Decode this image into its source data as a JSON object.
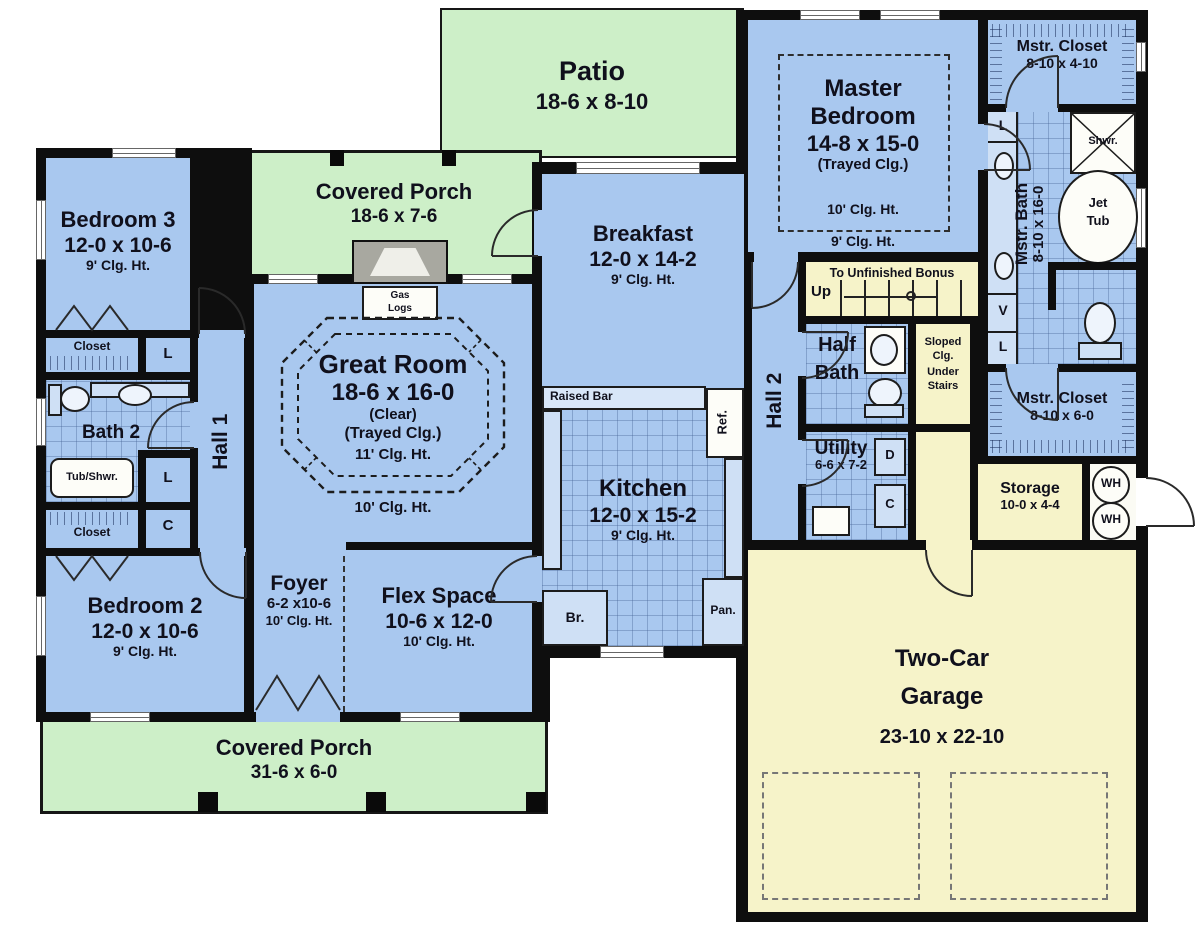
{
  "plan": {
    "patio": {
      "name": "Patio",
      "dims": "18-6 x 8-10"
    },
    "porch_top": {
      "name": "Covered Porch",
      "dims": "18-6 x 7-6"
    },
    "porch_bottom": {
      "name": "Covered Porch",
      "dims": "31-6 x 6-0"
    },
    "bedroom3": {
      "name": "Bedroom 3",
      "dims": "12-0 x 10-6",
      "clg": "9' Clg. Ht."
    },
    "bedroom2": {
      "name": "Bedroom 2",
      "dims": "12-0 x 10-6",
      "clg": "9' Clg. Ht."
    },
    "closet_top": {
      "name": "Closet"
    },
    "closet_bottom": {
      "name": "Closet"
    },
    "linen_upper": "L",
    "linen_lower": "L",
    "coat": "C",
    "bath2": {
      "name": "Bath 2",
      "tub": "Tub/Shwr."
    },
    "hall1": {
      "name": "Hall 1"
    },
    "hall2": {
      "name": "Hall 2"
    },
    "foyer": {
      "name": "Foyer",
      "dims": "6-2 x10-6",
      "clg": "10' Clg. Ht."
    },
    "flex": {
      "name": "Flex Space",
      "dims": "10-6 x 12-0",
      "clg": "10' Clg. Ht."
    },
    "great_room": {
      "name": "Great Room",
      "dims": "18-6 x 16-0",
      "clear": "(Clear)",
      "tray": "(Trayed Clg.)",
      "clg_inner": "11' Clg. Ht.",
      "clg_outer": "10' Clg. Ht."
    },
    "fireplace": {
      "line1": "Gas",
      "line2": "Logs"
    },
    "breakfast": {
      "name": "Breakfast",
      "dims": "12-0 x 14-2",
      "clg": "9' Clg. Ht."
    },
    "kitchen": {
      "name": "Kitchen",
      "dims": "12-0 x 15-2",
      "clg": "9' Clg. Ht.",
      "raised_bar": "Raised Bar",
      "ref": "Ref.",
      "br": "Br.",
      "pan": "Pan."
    },
    "master_bedroom": {
      "name1": "Master",
      "name2": "Bedroom",
      "dims": "14-8 x 15-0",
      "tray": "(Trayed Clg.)",
      "clg_inner": "10' Clg. Ht.",
      "clg_outer": "9' Clg. Ht."
    },
    "mstr_closet_top": {
      "name": "Mstr. Closet",
      "dims": "8-10 x 4-10"
    },
    "mstr_closet_bottom": {
      "name": "Mstr. Closet",
      "dims": "8-10 x 6-0"
    },
    "mstr_bath": {
      "name": "Mstr. Bath",
      "dims": "8-10 x 16-0",
      "shower": "Shwr.",
      "tub1": "Jet",
      "tub2": "Tub",
      "vanity": "V",
      "linen_top": "L",
      "linen_bottom": "L"
    },
    "stairs": {
      "label": "To Unfinished Bonus",
      "up": "Up"
    },
    "half_bath": {
      "name1": "Half",
      "name2": "Bath"
    },
    "sloped": {
      "l1": "Sloped",
      "l2": "Clg.",
      "l3": "Under",
      "l4": "Stairs"
    },
    "utility": {
      "name": "Utility",
      "dims": "6-6 x 7-2",
      "d": "D",
      "c": "C"
    },
    "storage": {
      "name": "Storage",
      "dims": "10-0 x 4-4"
    },
    "wh1": "WH",
    "wh2": "WH",
    "garage": {
      "name1": "Two-Car",
      "name2": "Garage",
      "dims": "23-10 x 22-10"
    }
  },
  "colors": {
    "room": "#a9c8ef",
    "porch": "#cdefc8",
    "garage": "#f6f3c9",
    "wall": "#0e0e0e",
    "fixture": "#cfe0f5"
  }
}
